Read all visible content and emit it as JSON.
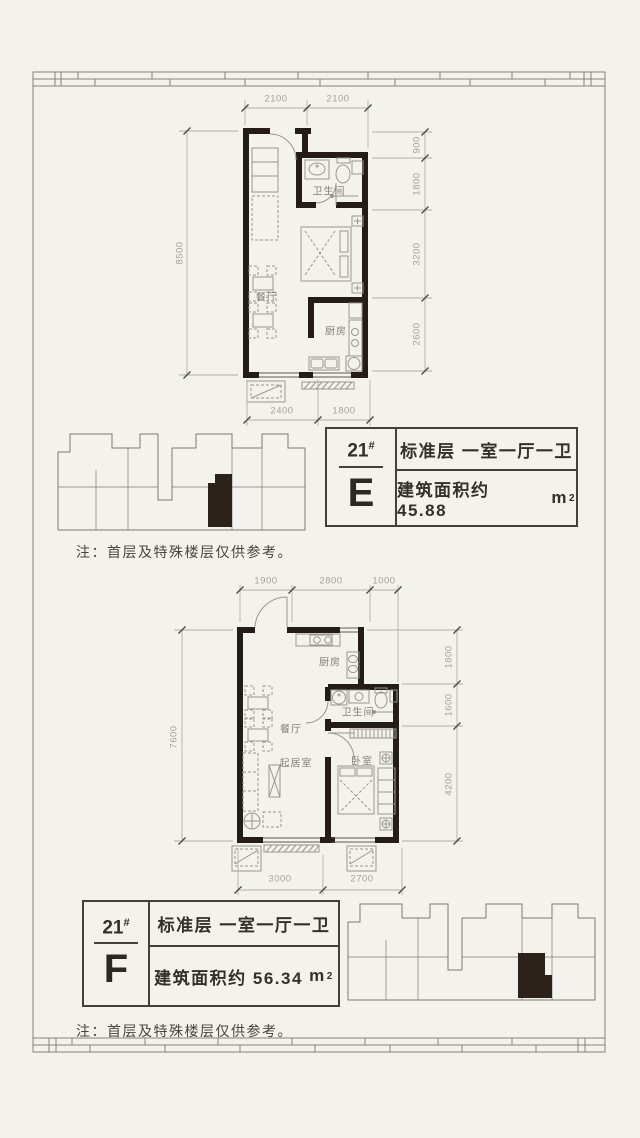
{
  "colors": {
    "background": "#f4f2ec",
    "wall": "#241c15",
    "line_gray": "#908d86",
    "dim_text": "#a6a29a",
    "accent_dark": "#3c362f"
  },
  "notes": {
    "top": "注：首层及特殊楼层仅供参考。",
    "bottom": "注：首层及特殊楼层仅供参考。"
  },
  "plan_e": {
    "dims_top": [
      "2100",
      "2100"
    ],
    "dims_left": [
      "8500"
    ],
    "dims_right": [
      "900",
      "1800",
      "3200",
      "2600"
    ],
    "dims_bottom": [
      "2400",
      "1800"
    ],
    "rooms": {
      "bath": "卫生间",
      "kitchen": "厨房",
      "dining": "餐厅"
    }
  },
  "plan_f": {
    "dims_top": [
      "1900",
      "2800",
      "1000"
    ],
    "dims_left": [
      "7600"
    ],
    "dims_right": [
      "1800",
      "1600",
      "4200"
    ],
    "dims_bottom": [
      "3000",
      "2700"
    ],
    "rooms": {
      "kitchen": "厨房",
      "bath": "卫生间",
      "dining": "餐厅",
      "living": "起居室",
      "bedroom": "卧室"
    }
  },
  "unit_e": {
    "building": "21",
    "building_sup": "#",
    "unit": "E",
    "spec": "标准层 一室一厅一卫",
    "area": "建筑面积约 45.88",
    "area_unit": "m",
    "area_unit_sup": "2"
  },
  "unit_f": {
    "building": "21",
    "building_sup": "#",
    "unit": "F",
    "spec": "标准层 一室一厅一卫",
    "area": "建筑面积约 56.34",
    "area_unit": "m",
    "area_unit_sup": "2"
  }
}
